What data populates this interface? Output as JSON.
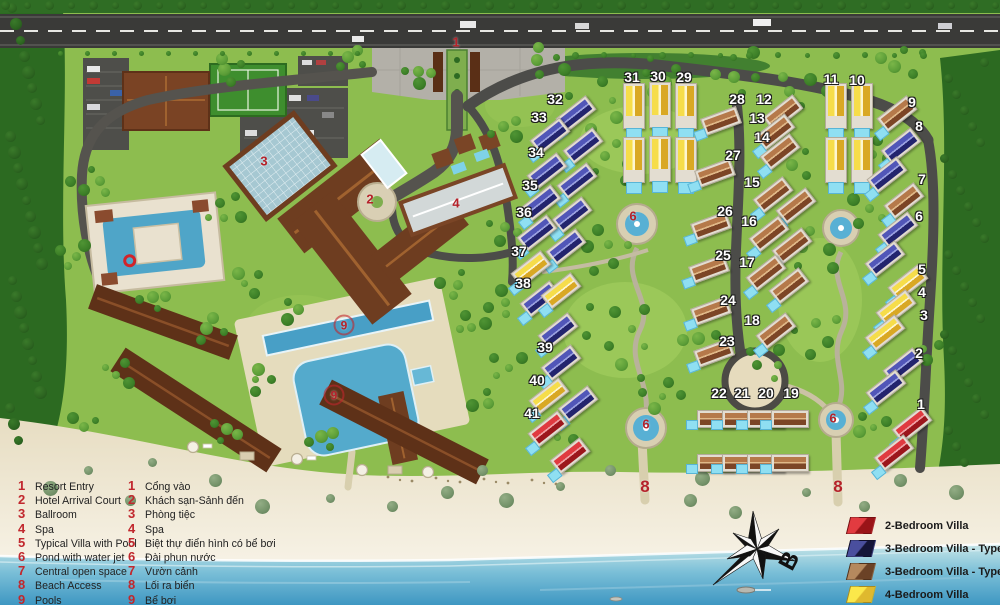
{
  "legend_facilities": [
    {
      "n": "1",
      "en": "Resort Entry",
      "vi": "Cổng vào"
    },
    {
      "n": "2",
      "en": "Hotel Arrival Court",
      "vi": "Khách sạn-Sảnh đến"
    },
    {
      "n": "3",
      "en": "Ballroom",
      "vi": "Phòng tiệc"
    },
    {
      "n": "4",
      "en": "Spa",
      "vi": "Spa"
    },
    {
      "n": "5",
      "en": "Typical Villa with Pool",
      "vi": "Biệt thự điển hình có bể bơi"
    },
    {
      "n": "6",
      "en": "Pond with water jet",
      "vi": "Đài phun nước"
    },
    {
      "n": "7",
      "en": "Central open space",
      "vi": "Vườn cảnh"
    },
    {
      "n": "8",
      "en": "Beach Access",
      "vi": "Lối ra biển"
    },
    {
      "n": "9",
      "en": "Pools",
      "vi": "Bể bơi"
    }
  ],
  "legend_villa_types": [
    {
      "label": "2-Bedroom Villa",
      "light": "#e23b40",
      "dark": "#9a1418"
    },
    {
      "label": "3-Bedroom Villa  - Type A",
      "light": "#4a4f9e",
      "dark": "#141538"
    },
    {
      "label": "3-Bedroom Villa - Type B",
      "light": "#b5895e",
      "dark": "#6b4226"
    },
    {
      "label": "4-Bedroom Villa",
      "light": "#fbe84a",
      "dark": "#dfb92e"
    }
  ],
  "compass": {
    "north_label": "B"
  },
  "colors": {
    "grass": "#8dbd4f",
    "forest": "#2c6a21",
    "sand": "#ebe2cc",
    "sea": "#5aadcf",
    "pool": "#54aacc",
    "road": "#4c4c49",
    "roof_hotel": "#5e3118",
    "villa_2br": "#d6242c",
    "villa_3br_a": "#2b2d7a",
    "villa_3br_b": "#8a4b2e",
    "villa_4br": "#f0cf3a"
  },
  "map": {
    "villa_number_labels": [
      {
        "n": "32",
        "x": 555,
        "y": 99
      },
      {
        "n": "33",
        "x": 539,
        "y": 117
      },
      {
        "n": "34",
        "x": 536,
        "y": 152
      },
      {
        "n": "35",
        "x": 530,
        "y": 185
      },
      {
        "n": "36",
        "x": 524,
        "y": 212
      },
      {
        "n": "37",
        "x": 519,
        "y": 251
      },
      {
        "n": "38",
        "x": 523,
        "y": 283
      },
      {
        "n": "39",
        "x": 545,
        "y": 347
      },
      {
        "n": "40",
        "x": 537,
        "y": 380
      },
      {
        "n": "41",
        "x": 532,
        "y": 413
      },
      {
        "n": "31",
        "x": 632,
        "y": 77
      },
      {
        "n": "30",
        "x": 658,
        "y": 76
      },
      {
        "n": "29",
        "x": 684,
        "y": 77
      },
      {
        "n": "28",
        "x": 737,
        "y": 99
      },
      {
        "n": "27",
        "x": 733,
        "y": 155
      },
      {
        "n": "26",
        "x": 725,
        "y": 211
      },
      {
        "n": "25",
        "x": 723,
        "y": 255
      },
      {
        "n": "24",
        "x": 728,
        "y": 300
      },
      {
        "n": "23",
        "x": 727,
        "y": 341
      },
      {
        "n": "12",
        "x": 764,
        "y": 99
      },
      {
        "n": "13",
        "x": 757,
        "y": 118
      },
      {
        "n": "14",
        "x": 762,
        "y": 137
      },
      {
        "n": "15",
        "x": 752,
        "y": 182
      },
      {
        "n": "16",
        "x": 749,
        "y": 221
      },
      {
        "n": "17",
        "x": 747,
        "y": 262
      },
      {
        "n": "18",
        "x": 752,
        "y": 320
      },
      {
        "n": "22",
        "x": 719,
        "y": 393
      },
      {
        "n": "21",
        "x": 742,
        "y": 393
      },
      {
        "n": "20",
        "x": 766,
        "y": 393
      },
      {
        "n": "19",
        "x": 791,
        "y": 393
      },
      {
        "n": "11",
        "x": 831,
        "y": 79
      },
      {
        "n": "10",
        "x": 857,
        "y": 80
      },
      {
        "n": "9",
        "x": 912,
        "y": 102
      },
      {
        "n": "8",
        "x": 919,
        "y": 126
      },
      {
        "n": "7",
        "x": 922,
        "y": 179
      },
      {
        "n": "6",
        "x": 919,
        "y": 216
      },
      {
        "n": "5",
        "x": 922,
        "y": 269
      },
      {
        "n": "4",
        "x": 922,
        "y": 292
      },
      {
        "n": "3",
        "x": 924,
        "y": 315
      },
      {
        "n": "2",
        "x": 919,
        "y": 353
      },
      {
        "n": "1",
        "x": 921,
        "y": 404
      }
    ],
    "facility_markers": [
      {
        "n": "1",
        "x": 456,
        "y": 42
      },
      {
        "n": "2",
        "x": 370,
        "y": 199
      },
      {
        "n": "3",
        "x": 264,
        "y": 161
      },
      {
        "n": "4",
        "x": 456,
        "y": 203
      },
      {
        "n": "9",
        "x": 344,
        "y": 325
      },
      {
        "n": "9",
        "x": 334,
        "y": 395
      },
      {
        "n": "6",
        "x": 633,
        "y": 216
      },
      {
        "n": "6",
        "x": 646,
        "y": 424
      },
      {
        "n": "6",
        "x": 833,
        "y": 418
      },
      {
        "n": "8",
        "x": 645,
        "y": 487,
        "s": "lg"
      },
      {
        "n": "8",
        "x": 838,
        "y": 487,
        "s": "lg"
      }
    ],
    "villas": [
      {
        "x": 576,
        "y": 114,
        "r": -38,
        "t": "a"
      },
      {
        "x": 583,
        "y": 146,
        "r": -38,
        "t": "a"
      },
      {
        "x": 550,
        "y": 136,
        "r": -38,
        "t": "a"
      },
      {
        "x": 547,
        "y": 171,
        "r": -38,
        "t": "a"
      },
      {
        "x": 577,
        "y": 181,
        "r": -38,
        "t": "a"
      },
      {
        "x": 541,
        "y": 203,
        "r": -38,
        "t": "a"
      },
      {
        "x": 572,
        "y": 215,
        "r": -38,
        "t": "a"
      },
      {
        "x": 537,
        "y": 233,
        "r": -38,
        "t": "a"
      },
      {
        "x": 566,
        "y": 247,
        "r": -38,
        "t": "a"
      },
      {
        "x": 531,
        "y": 269,
        "r": -38,
        "t": "y"
      },
      {
        "x": 540,
        "y": 299,
        "r": -38,
        "t": "a"
      },
      {
        "x": 561,
        "y": 291,
        "r": -38,
        "t": "y"
      },
      {
        "x": 558,
        "y": 331,
        "r": -38,
        "t": "a"
      },
      {
        "x": 561,
        "y": 363,
        "r": -38,
        "t": "a"
      },
      {
        "x": 549,
        "y": 396,
        "r": -38,
        "t": "y"
      },
      {
        "x": 578,
        "y": 404,
        "r": -38,
        "t": "a"
      },
      {
        "x": 548,
        "y": 429,
        "r": -38,
        "t": "r"
      },
      {
        "x": 570,
        "y": 456,
        "r": -38,
        "t": "r"
      },
      {
        "x": 634,
        "y": 106,
        "t": "y",
        "o": "v"
      },
      {
        "x": 660,
        "y": 105,
        "t": "y",
        "o": "v"
      },
      {
        "x": 686,
        "y": 106,
        "t": "y",
        "o": "v"
      },
      {
        "x": 634,
        "y": 160,
        "t": "y",
        "o": "v"
      },
      {
        "x": 660,
        "y": 159,
        "t": "y",
        "o": "v"
      },
      {
        "x": 686,
        "y": 160,
        "t": "y",
        "o": "v"
      },
      {
        "x": 836,
        "y": 106,
        "t": "y",
        "o": "v"
      },
      {
        "x": 862,
        "y": 106,
        "t": "y",
        "o": "v"
      },
      {
        "x": 836,
        "y": 160,
        "t": "y",
        "o": "v"
      },
      {
        "x": 862,
        "y": 160,
        "t": "y",
        "o": "v"
      },
      {
        "x": 721,
        "y": 121,
        "r": -20,
        "t": "b"
      },
      {
        "x": 715,
        "y": 173,
        "r": -20,
        "t": "b"
      },
      {
        "x": 711,
        "y": 226,
        "r": -20,
        "t": "b"
      },
      {
        "x": 709,
        "y": 269,
        "r": -20,
        "t": "b"
      },
      {
        "x": 711,
        "y": 311,
        "r": -20,
        "t": "b"
      },
      {
        "x": 714,
        "y": 353,
        "r": -20,
        "t": "b"
      },
      {
        "x": 783,
        "y": 113,
        "r": -38,
        "t": "b"
      },
      {
        "x": 775,
        "y": 132,
        "r": -38,
        "t": "b"
      },
      {
        "x": 780,
        "y": 152,
        "r": -38,
        "t": "b"
      },
      {
        "x": 773,
        "y": 195,
        "r": -38,
        "t": "b"
      },
      {
        "x": 796,
        "y": 206,
        "r": -38,
        "t": "b"
      },
      {
        "x": 769,
        "y": 234,
        "r": -38,
        "t": "b"
      },
      {
        "x": 792,
        "y": 246,
        "r": -38,
        "t": "b"
      },
      {
        "x": 766,
        "y": 273,
        "r": -38,
        "t": "b"
      },
      {
        "x": 789,
        "y": 286,
        "r": -38,
        "t": "b"
      },
      {
        "x": 776,
        "y": 331,
        "r": -38,
        "t": "b"
      },
      {
        "x": 897,
        "y": 114,
        "r": -38,
        "t": "b"
      },
      {
        "x": 901,
        "y": 146,
        "r": -38,
        "t": "a"
      },
      {
        "x": 887,
        "y": 175,
        "r": -38,
        "t": "a"
      },
      {
        "x": 904,
        "y": 201,
        "r": -38,
        "t": "b"
      },
      {
        "x": 898,
        "y": 230,
        "r": -38,
        "t": "a"
      },
      {
        "x": 885,
        "y": 259,
        "r": -38,
        "t": "a"
      },
      {
        "x": 908,
        "y": 283,
        "r": -38,
        "t": "y"
      },
      {
        "x": 896,
        "y": 308,
        "r": -38,
        "t": "y"
      },
      {
        "x": 885,
        "y": 333,
        "r": -38,
        "t": "y"
      },
      {
        "x": 903,
        "y": 366,
        "r": -38,
        "t": "a"
      },
      {
        "x": 886,
        "y": 388,
        "r": -38,
        "t": "a"
      },
      {
        "x": 912,
        "y": 425,
        "r": -38,
        "t": "r"
      },
      {
        "x": 894,
        "y": 453,
        "r": -38,
        "t": "r"
      },
      {
        "x": 716,
        "y": 419,
        "t": "bc"
      },
      {
        "x": 741,
        "y": 419,
        "t": "bc"
      },
      {
        "x": 766,
        "y": 419,
        "t": "bc"
      },
      {
        "x": 790,
        "y": 419,
        "t": "bc"
      },
      {
        "x": 716,
        "y": 463,
        "t": "bc",
        "p": 1
      },
      {
        "x": 741,
        "y": 463,
        "t": "bc",
        "p": 1
      },
      {
        "x": 766,
        "y": 463,
        "t": "bc",
        "p": 1
      },
      {
        "x": 790,
        "y": 463,
        "t": "bc",
        "p": 1
      }
    ]
  }
}
